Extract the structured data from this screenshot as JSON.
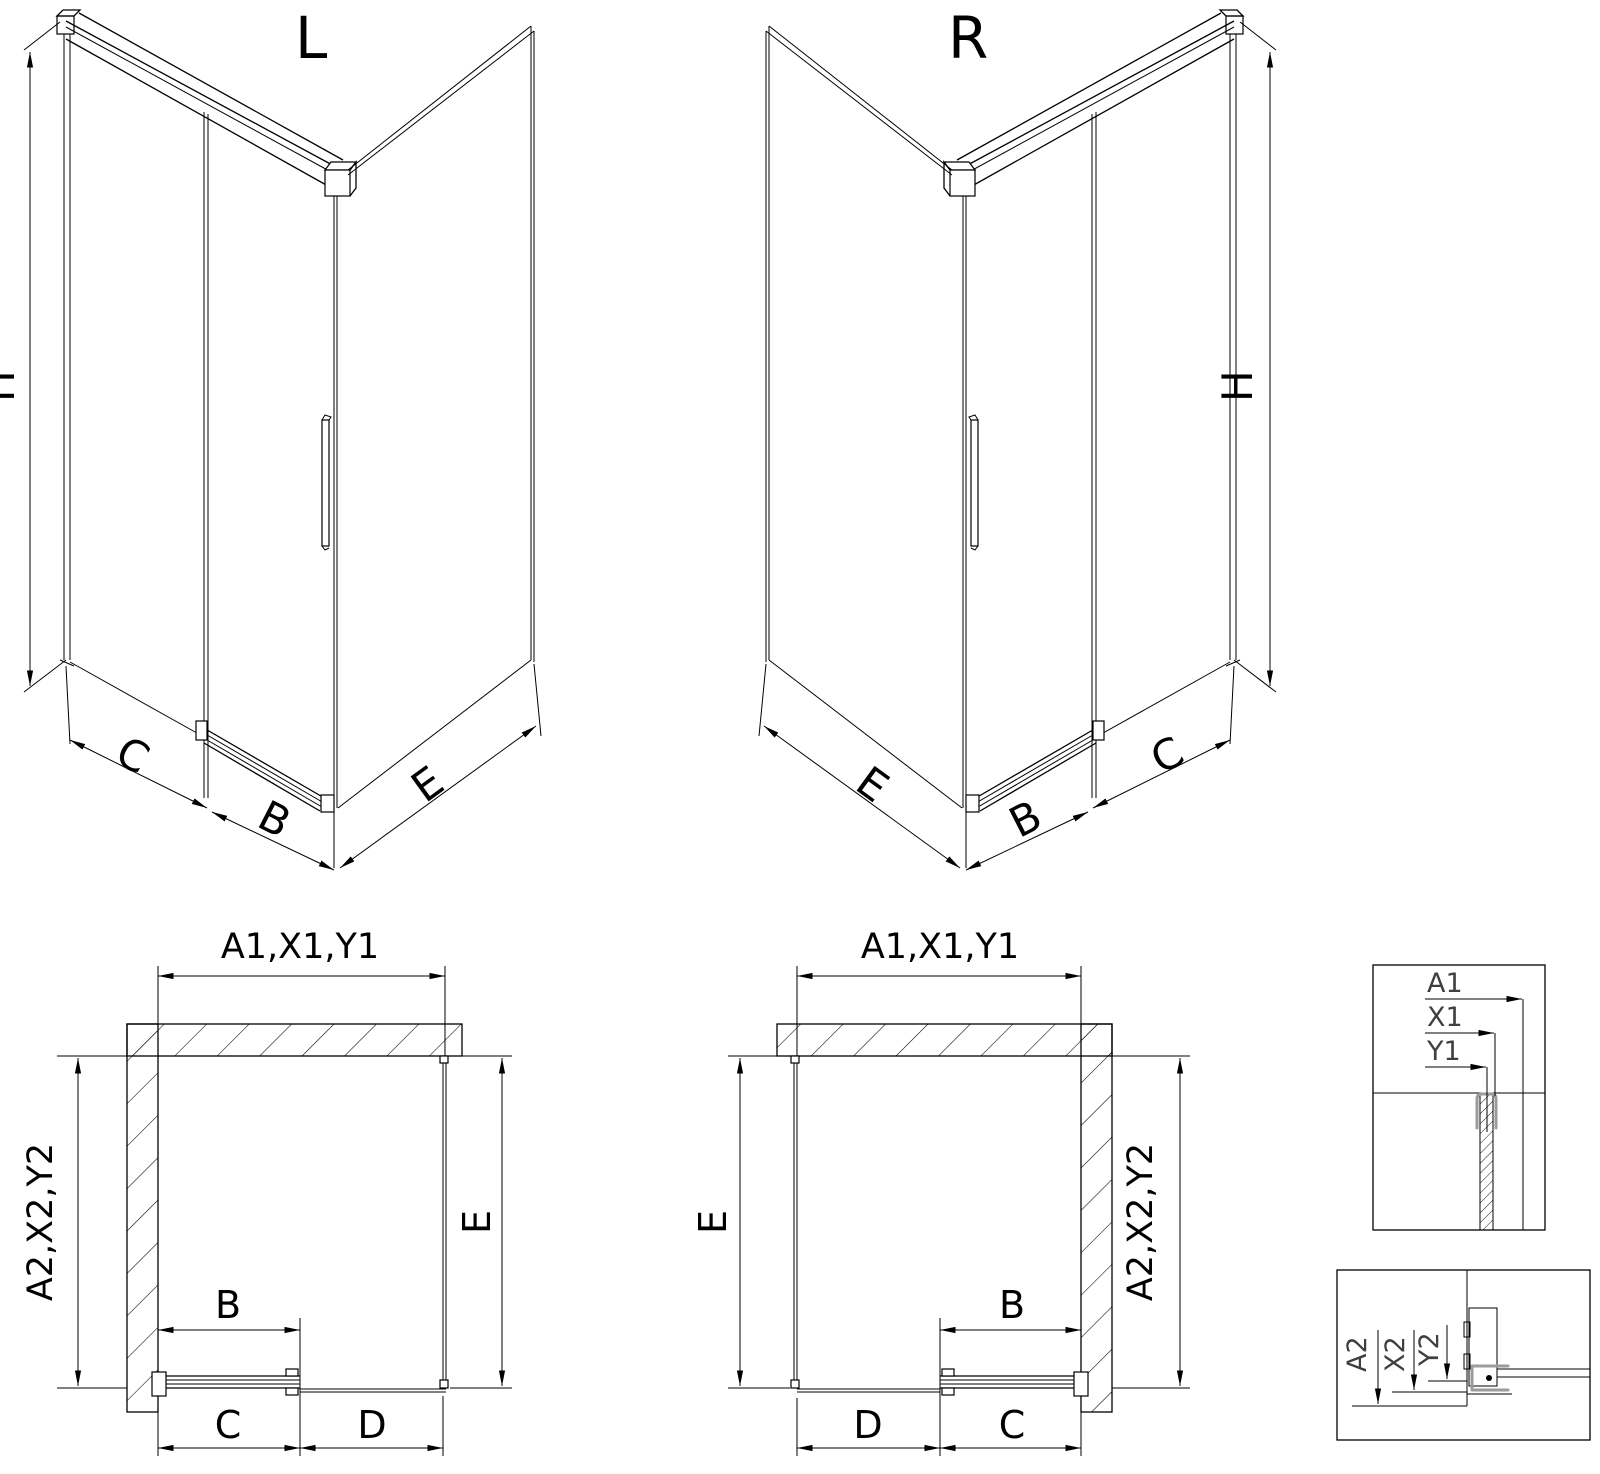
{
  "drawing": {
    "iso_l": {
      "title": "L",
      "dim_height": "H",
      "dim_c": "C",
      "dim_b": "B",
      "dim_e": "E"
    },
    "iso_r": {
      "title": "R",
      "dim_height": "H",
      "dim_e": "E",
      "dim_b": "B",
      "dim_c": "C"
    },
    "plan_l": {
      "dim_width_top": "A1,X1,Y1",
      "dim_depth_left": "A2,X2,Y2",
      "dim_e": "E",
      "dim_b": "B",
      "dim_c": "C",
      "dim_d": "D"
    },
    "plan_r": {
      "dim_width_top": "A1,X1,Y1",
      "dim_e": "E",
      "dim_depth_right": "A2,X2,Y2",
      "dim_b": "B",
      "dim_d": "D",
      "dim_c": "C"
    },
    "detail_top": {
      "dim_a1": "A1",
      "dim_x1": "X1",
      "dim_y1": "Y1"
    },
    "detail_bottom": {
      "dim_a2": "A2",
      "dim_x2": "X2",
      "dim_y2": "Y2"
    },
    "colors": {
      "line": "#000000",
      "detail_label": "#3f3f3f",
      "clamp_gray": "#9b9b9b",
      "background": "#ffffff"
    }
  }
}
